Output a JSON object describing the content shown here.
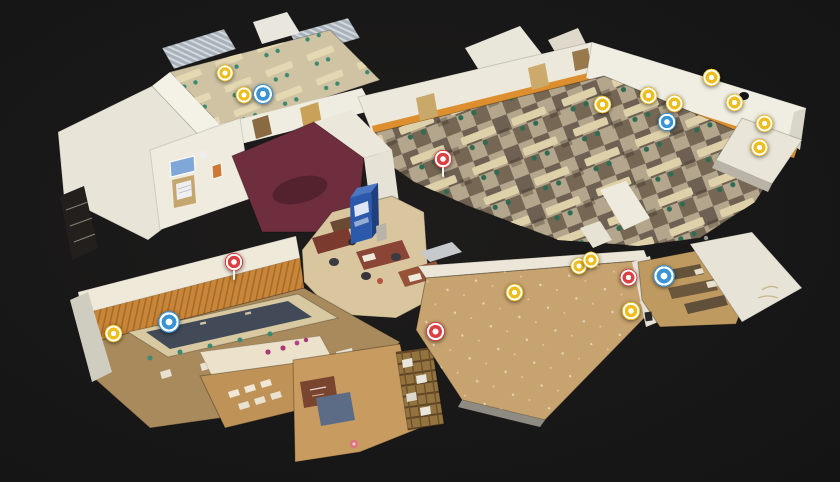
{
  "viewer": {
    "background_color": "#1a1a1a",
    "view_mode_icon": "dollhouse-3d-view"
  },
  "palette": {
    "wall_white": "#ece8db",
    "wainscot_orange": "#dd8f2f",
    "carpet_light": "#b3a68c",
    "carpet_dark": "#6e6153",
    "gym_floor": "#c7a36f",
    "maroon_carpet": "#6e2e3e",
    "roof_metal": "#aab3ba",
    "vending_blue": "#2b59ab"
  },
  "tag_colors": {
    "yellow": "#eebd1c",
    "blue": "#3a93d5",
    "red": "#dd4040",
    "pink": "#df6e84"
  },
  "markers": [
    {
      "id": "tag-01",
      "color": "yellow",
      "x": 225,
      "y": 73,
      "size": 20
    },
    {
      "id": "tag-02",
      "color": "yellow",
      "x": 244,
      "y": 95,
      "size": 20
    },
    {
      "id": "tag-03",
      "color": "blue",
      "x": 263,
      "y": 94,
      "size": 24
    },
    {
      "id": "tag-04",
      "color": "red",
      "x": 443,
      "y": 159,
      "size": 22,
      "stem": true
    },
    {
      "id": "tag-05",
      "color": "yellow",
      "x": 602,
      "y": 104,
      "size": 21
    },
    {
      "id": "tag-06",
      "color": "yellow",
      "x": 648,
      "y": 95,
      "size": 21
    },
    {
      "id": "tag-07",
      "color": "yellow",
      "x": 674,
      "y": 103,
      "size": 21
    },
    {
      "id": "tag-08",
      "color": "blue",
      "x": 667,
      "y": 122,
      "size": 22
    },
    {
      "id": "tag-09",
      "color": "yellow",
      "x": 711,
      "y": 77,
      "size": 21
    },
    {
      "id": "tag-10",
      "color": "yellow",
      "x": 734,
      "y": 102,
      "size": 21
    },
    {
      "id": "tag-11",
      "color": "yellow",
      "x": 764,
      "y": 123,
      "size": 21
    },
    {
      "id": "tag-12",
      "color": "yellow",
      "x": 759,
      "y": 147,
      "size": 21
    },
    {
      "id": "tag-13",
      "color": "red",
      "x": 234,
      "y": 262,
      "size": 22,
      "stem": true
    },
    {
      "id": "tag-14",
      "color": "blue",
      "x": 169,
      "y": 322,
      "size": 26
    },
    {
      "id": "tag-15",
      "color": "yellow",
      "x": 113,
      "y": 333,
      "size": 21
    },
    {
      "id": "tag-16",
      "color": "yellow",
      "x": 579,
      "y": 266,
      "size": 20
    },
    {
      "id": "tag-17",
      "color": "yellow",
      "x": 591,
      "y": 260,
      "size": 20
    },
    {
      "id": "tag-18",
      "color": "red",
      "x": 628,
      "y": 277,
      "size": 21
    },
    {
      "id": "tag-19",
      "color": "blue",
      "x": 664,
      "y": 276,
      "size": 26
    },
    {
      "id": "tag-20",
      "color": "yellow",
      "x": 514,
      "y": 292,
      "size": 21
    },
    {
      "id": "tag-21",
      "color": "yellow",
      "x": 631,
      "y": 311,
      "size": 22
    },
    {
      "id": "tag-22",
      "color": "red",
      "x": 435,
      "y": 331,
      "size": 23
    },
    {
      "id": "tag-23",
      "color": "pink",
      "x": 354,
      "y": 444,
      "size": 10,
      "faded": true
    }
  ]
}
